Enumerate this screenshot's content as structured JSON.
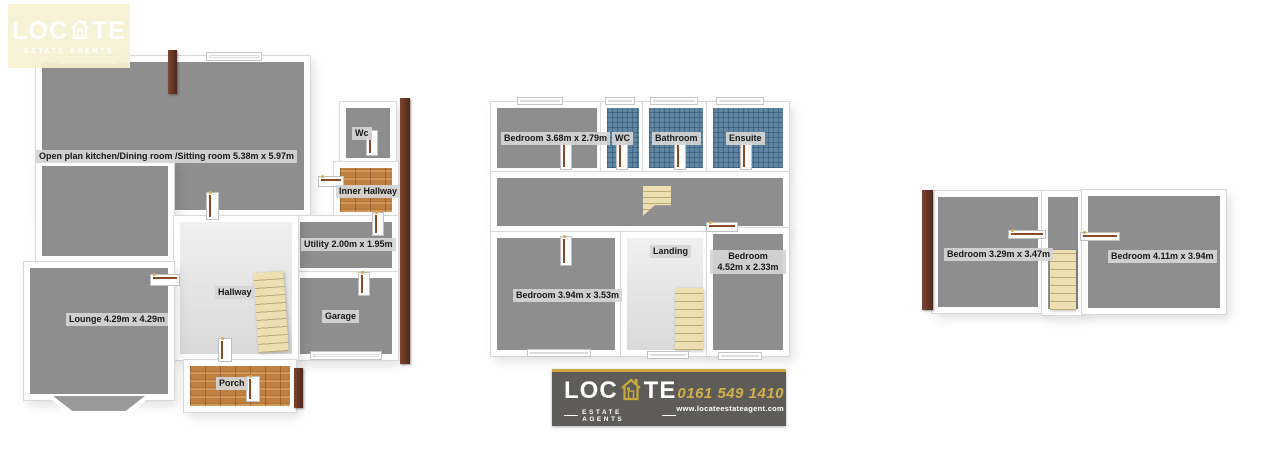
{
  "watermark_logo": {
    "brand_pre": "LOC",
    "brand_post": "TE",
    "tagline": "ESTATE AGENTS"
  },
  "banner": {
    "brand_pre": "LOC",
    "brand_post": "TE",
    "tagline": "ESTATE AGENTS",
    "phone": "0161 549 1410",
    "website": "www.locateestateagent.com"
  },
  "floors": {
    "ground": {
      "rooms": [
        {
          "name": "open-plan",
          "label": "Open plan kitchen/Dining room /Sitting room 5.38m x 5.97m"
        },
        {
          "name": "wc",
          "label": "Wc"
        },
        {
          "name": "inner-hallway",
          "label": "Inner Hallway"
        },
        {
          "name": "utility",
          "label": "Utility 2.00m x 1.95m"
        },
        {
          "name": "hallway",
          "label": "Hallway"
        },
        {
          "name": "garage",
          "label": "Garage"
        },
        {
          "name": "lounge",
          "label": "Lounge 4.29m x 4.29m"
        },
        {
          "name": "porch",
          "label": "Porch"
        }
      ]
    },
    "first": {
      "rooms": [
        {
          "name": "bedroom-1",
          "label": "Bedroom 3.68m x 2.79m"
        },
        {
          "name": "wc",
          "label": "WC"
        },
        {
          "name": "bathroom",
          "label": "Bathroom"
        },
        {
          "name": "ensuite",
          "label": "Ensuite"
        },
        {
          "name": "bedroom-2",
          "label": "Bedroom 3.94m x 3.53m"
        },
        {
          "name": "landing",
          "label": "Landing"
        },
        {
          "name": "bedroom-3",
          "label": "Bedroom",
          "label2": "4.52m x 2.33m"
        }
      ]
    },
    "second": {
      "rooms": [
        {
          "name": "bedroom-4",
          "label": "Bedroom 3.29m x 3.47m"
        },
        {
          "name": "bedroom-5",
          "label": "Bedroom 4.11m x 3.94m"
        }
      ]
    }
  },
  "colors": {
    "floor_gray": "#8e8e8e",
    "light_floor": "#ebebeb",
    "tile_blue": "#5e86a3",
    "wood_brown": "#c0803f",
    "stairs_cream": "#ecdfb2",
    "wall_edge_brown": "#6e3c28",
    "banner_bg": "#5d5c58",
    "brand_gold": "#c9a83d",
    "logo_cream": "#f6f1d3"
  }
}
